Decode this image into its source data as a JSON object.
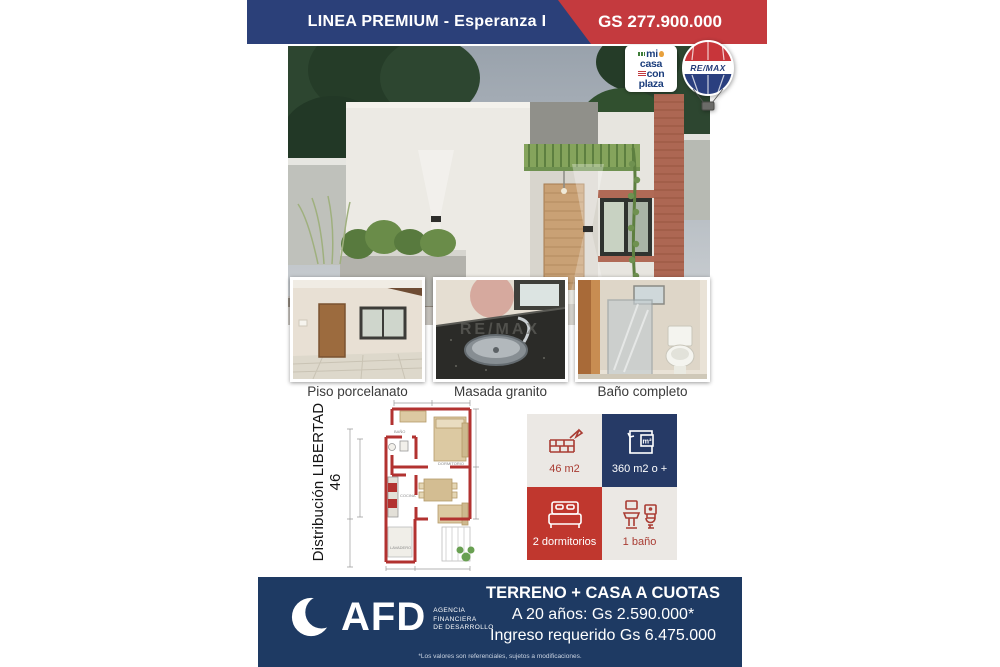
{
  "header": {
    "title": "LINEA PREMIUM - Esperanza I",
    "price": "GS 277.900.000"
  },
  "logos": {
    "micasa": {
      "words": [
        "mi",
        "casa",
        "con",
        "plaza"
      ]
    },
    "remax": {
      "label": "RE/MAX"
    }
  },
  "gallery": {
    "captions": [
      "Piso porcelanato",
      "Masada granito",
      "Baño completo"
    ],
    "watermark": "RE/MAX"
  },
  "floorplan": {
    "label": "Distribución LIBERTAD 46",
    "rooms": [
      "BAÑO",
      "DORMITORIO",
      "COCINA",
      "LAVADERO"
    ]
  },
  "stats": {
    "m2_label": "m²",
    "cells": [
      {
        "icon": "bricks-icon",
        "label": "46 m2"
      },
      {
        "icon": "area-icon",
        "label": "360 m2 o +"
      },
      {
        "icon": "bed-icon",
        "label": "2 dormitorios"
      },
      {
        "icon": "bath-icon",
        "label": "1 baño"
      }
    ]
  },
  "footer": {
    "brand": "AFD",
    "brand_sub": [
      "AGENCIA",
      "FINANCIERA",
      "DE DESARROLLO"
    ],
    "line1": "TERRENO + CASA A CUOTAS",
    "line2": "A 20 años: Gs 2.590.000*",
    "line3": "Ingreso requerido Gs 6.475.000",
    "disclaimer": "*Los valores son referenciales, sujetos a modificaciones."
  },
  "colors": {
    "header_blue": "#2b4079",
    "header_red": "#c43a3e",
    "footer_navy": "#1e3a63",
    "stat_navy": "#263a66",
    "stat_red": "#c0372e",
    "stat_light": "#ebe8e4",
    "icon_red": "#a93c33",
    "plan_wall_red": "#b23230"
  }
}
